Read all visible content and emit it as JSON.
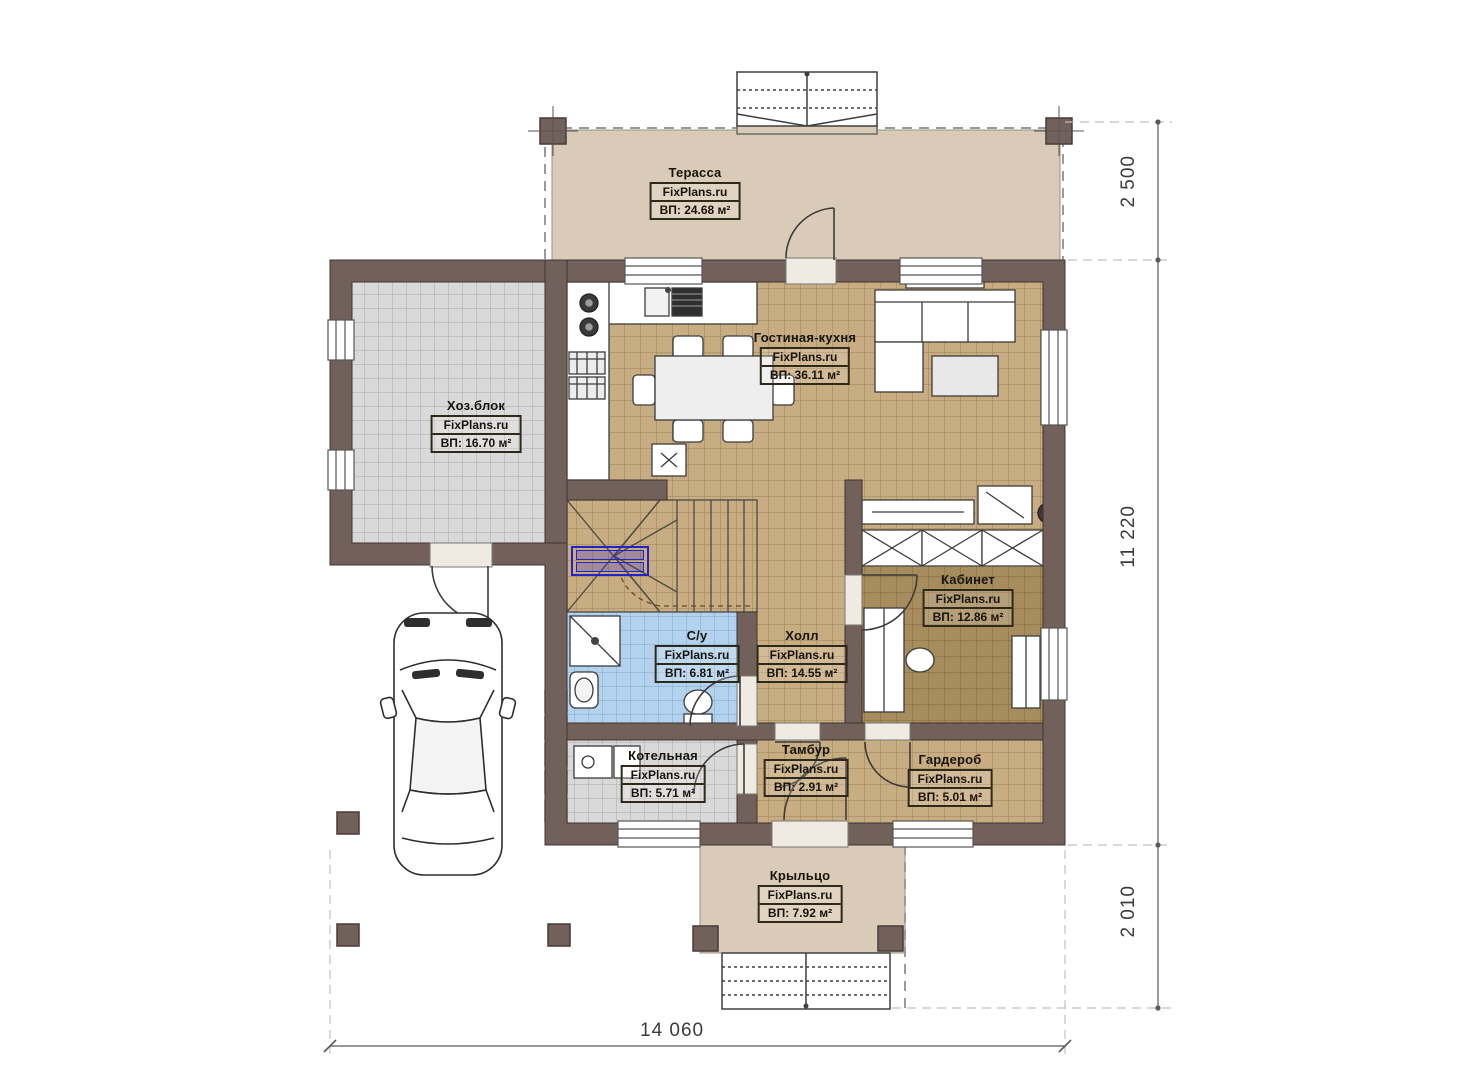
{
  "brand": "FixPlans.ru",
  "rooms": [
    {
      "key": "terrace",
      "name": "Терасса",
      "brand": "FixPlans.ru",
      "area": "ВП: 24.68 м²"
    },
    {
      "key": "hozblok",
      "name": "Хоз.блок",
      "brand": "FixPlans.ru",
      "area": "ВП: 16.70 м²"
    },
    {
      "key": "living-kitchen",
      "name": "Гостиная-кухня",
      "brand": "FixPlans.ru",
      "area": "ВП: 36.11 м²"
    },
    {
      "key": "cabinet",
      "name": "Кабинет",
      "brand": "FixPlans.ru",
      "area": "ВП: 12.86 м²"
    },
    {
      "key": "bathroom",
      "name": "С/у",
      "brand": "FixPlans.ru",
      "area": "ВП: 6.81 м²"
    },
    {
      "key": "hall",
      "name": "Холл",
      "brand": "FixPlans.ru",
      "area": "ВП: 14.55 м²"
    },
    {
      "key": "boiler",
      "name": "Котельная",
      "brand": "FixPlans.ru",
      "area": "ВП: 5.71 м²"
    },
    {
      "key": "vestibule",
      "name": "Тамбур",
      "brand": "FixPlans.ru",
      "area": "ВП: 2.91 м²"
    },
    {
      "key": "wardrobe",
      "name": "Гардероб",
      "brand": "FixPlans.ru",
      "area": "ВП: 5.01 м²"
    },
    {
      "key": "porch",
      "name": "Крыльцо",
      "brand": "FixPlans.ru",
      "area": "ВП: 7.92 м²"
    }
  ],
  "dimensions": {
    "terrace_depth": "2 500",
    "house_height": "11 220",
    "porch_depth": "2 010",
    "total_width": "14 060"
  },
  "colors": {
    "wall": "#72605b",
    "floor_tan": "#c8ac82",
    "floor_gray": "#d9d9d9",
    "floor_blue": "#b3d2ee",
    "floor_brown": "#a78c5d",
    "floor_terrace": "#d9cbb7",
    "annotation_blue": "#2222cc"
  }
}
